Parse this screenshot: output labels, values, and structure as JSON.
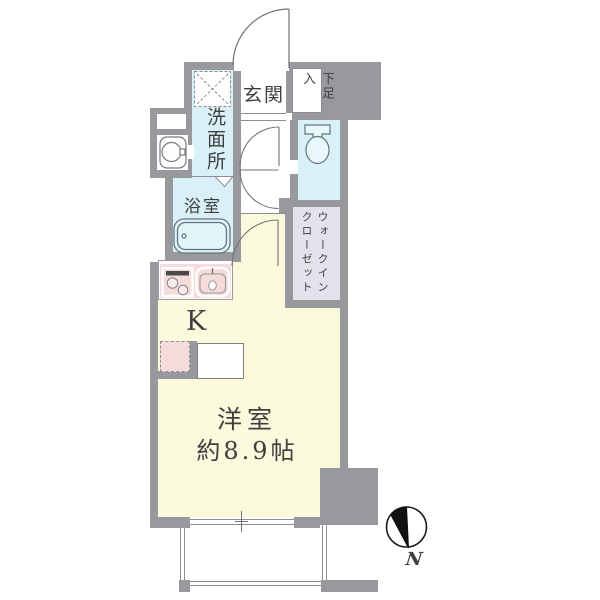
{
  "floorplan": {
    "labels": {
      "entrance": "玄関",
      "shoe_box": "下足入",
      "washroom": "洗面所",
      "bathroom": "浴室",
      "walk_in_closet_line1": "ウォークイン",
      "walk_in_closet_line2": "クローゼット",
      "kitchen": "K",
      "main_room": "洋室",
      "main_room_size": "約8.9帖",
      "compass_north": "N"
    },
    "colors": {
      "wall": "#97999d",
      "wet_area_floor": "#d9f1f6",
      "living_floor": "#fbfadd",
      "kitchen_accent": "#f6dbdb",
      "closet_floor": "#e1e2ec",
      "outline": "#707276",
      "text": "#3f3f3f"
    }
  }
}
